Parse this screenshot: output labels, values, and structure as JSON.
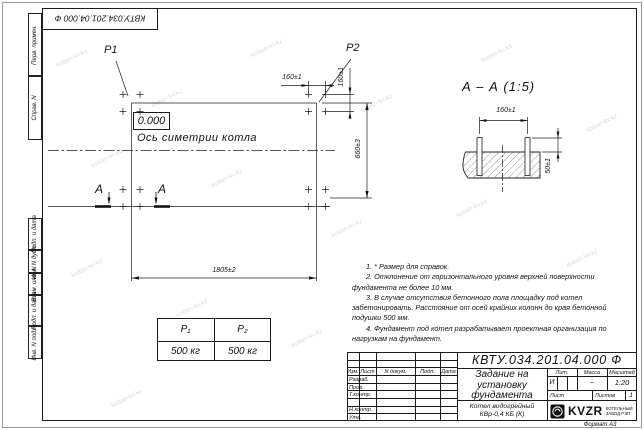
{
  "doc_number": "КВТУ.034.201.04.000 Ф",
  "watermark": "kotlan-kv.kz",
  "margin_labels": {
    "perv_primen": "Перв. примен.",
    "sprav_n": "Справ. N",
    "podp_data_1": "Подп. и дата",
    "inv_dubl": "Инв. N дубл.",
    "vzam_inv": "Взам. инв. N",
    "podp_data_2": "Подп. и дата",
    "inv_podl": "Инв. N подл."
  },
  "plan": {
    "load_label_1": "P1",
    "load_label_2": "P2",
    "elevation_mark": "0.000",
    "axis_label": "Ось симетрии котла",
    "section_letter_1": "А",
    "section_letter_2": "А",
    "dim_width": "1805±2",
    "dim_depth": "660±3",
    "dim_bolt_spacing_h": "160±1",
    "dim_bolt_spacing_v": "160±1"
  },
  "section_view": {
    "title": "А – А (1:5)",
    "dim_bolt_spacing": "160±1",
    "dim_bolt_height": "50±1"
  },
  "loads_table": {
    "col1_header": "P₁",
    "col2_header": "P₂",
    "col1_value": "500 кг",
    "col2_value": "500 кг"
  },
  "notes": [
    "1. * Размер для справок.",
    "2. Отклонение от горизонтального уровня верхней поверхности фундамента не более 10 мм.",
    "3. В случае отсутствия бетонного пола площадку под котел забетонировать. Расстояние от осей крайних колонн до края бетонной подушки 500 мм.",
    "4. Фундамент под котел разрабатывает проектная организация по нагрузкам на фундамент."
  ],
  "title_block": {
    "doc_number": "КВТУ.034.201.04.000 Ф",
    "title": "Задание на установку фундамента",
    "product": "Котел водогрейный КВр-0,4 КБ (К)",
    "header_izm": "Изм.",
    "header_list": "Лист",
    "header_ndokum": "N докум.",
    "header_podp": "Подп.",
    "header_data": "Дата",
    "row_razrab": "Разраб.",
    "row_prov": "Пров.",
    "row_tkontr": "Т.контр.",
    "row_nkontr": "Н.контр.",
    "row_utv": "Утв.",
    "lit_header": "Лит.",
    "massa_header": "Масса",
    "masshtab_header": "Масштаб",
    "lit_value": "И",
    "massa_value": "–",
    "masshtab_value": "1:20",
    "list_label": "Лист",
    "listov_label": "Листов",
    "listov_value": "1",
    "company_name": "KVZR",
    "company_sub1": "КОТЕЛЬНЫЙ",
    "company_sub2": "ЗАВОД РЭП",
    "format_label": "Формат А3"
  }
}
